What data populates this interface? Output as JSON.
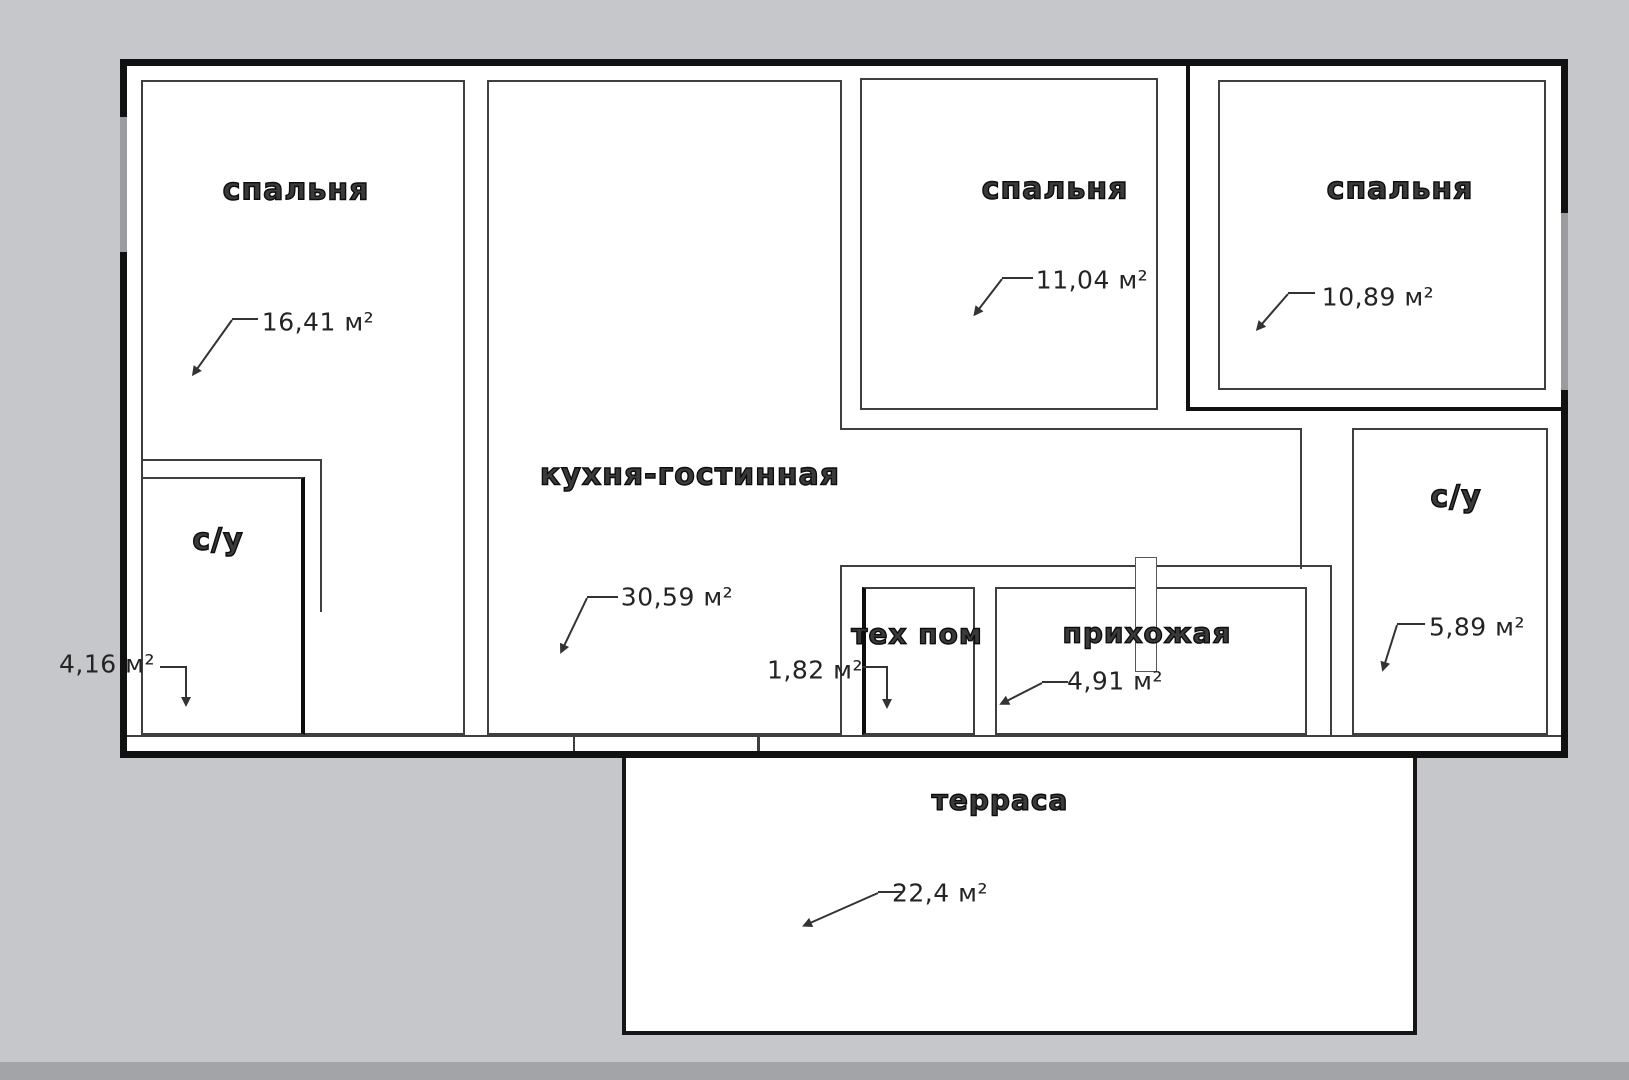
{
  "plan": {
    "type": "apartment-floor-plan",
    "language": "ru",
    "rooms": [
      {
        "id": "bedroom-1",
        "name": "спальня",
        "area": "16,41 м²"
      },
      {
        "id": "bathroom-1",
        "name": "с/у",
        "area": "4,16 м²"
      },
      {
        "id": "kitchen-living",
        "name": "кухня-гостинная",
        "area": "30,59 м²"
      },
      {
        "id": "bedroom-2",
        "name": "спальня",
        "area": "11,04 м²"
      },
      {
        "id": "bedroom-3",
        "name": "спальня",
        "area": "10,89 м²"
      },
      {
        "id": "tech-room",
        "name": "тех пом",
        "area": "1,82 м²"
      },
      {
        "id": "hallway",
        "name": "прихожая",
        "area": "4,91 м²"
      },
      {
        "id": "bathroom-2",
        "name": "с/у",
        "area": "5,89 м²"
      },
      {
        "id": "terrace",
        "name": "терраса",
        "area": "22,4 м²"
      }
    ],
    "colors": {
      "background": "#c6c7ca",
      "exterior_wall": "#111111",
      "interior_line": "#3f3f3f",
      "room_fill": "#ffffff",
      "leader": "#333333"
    }
  }
}
